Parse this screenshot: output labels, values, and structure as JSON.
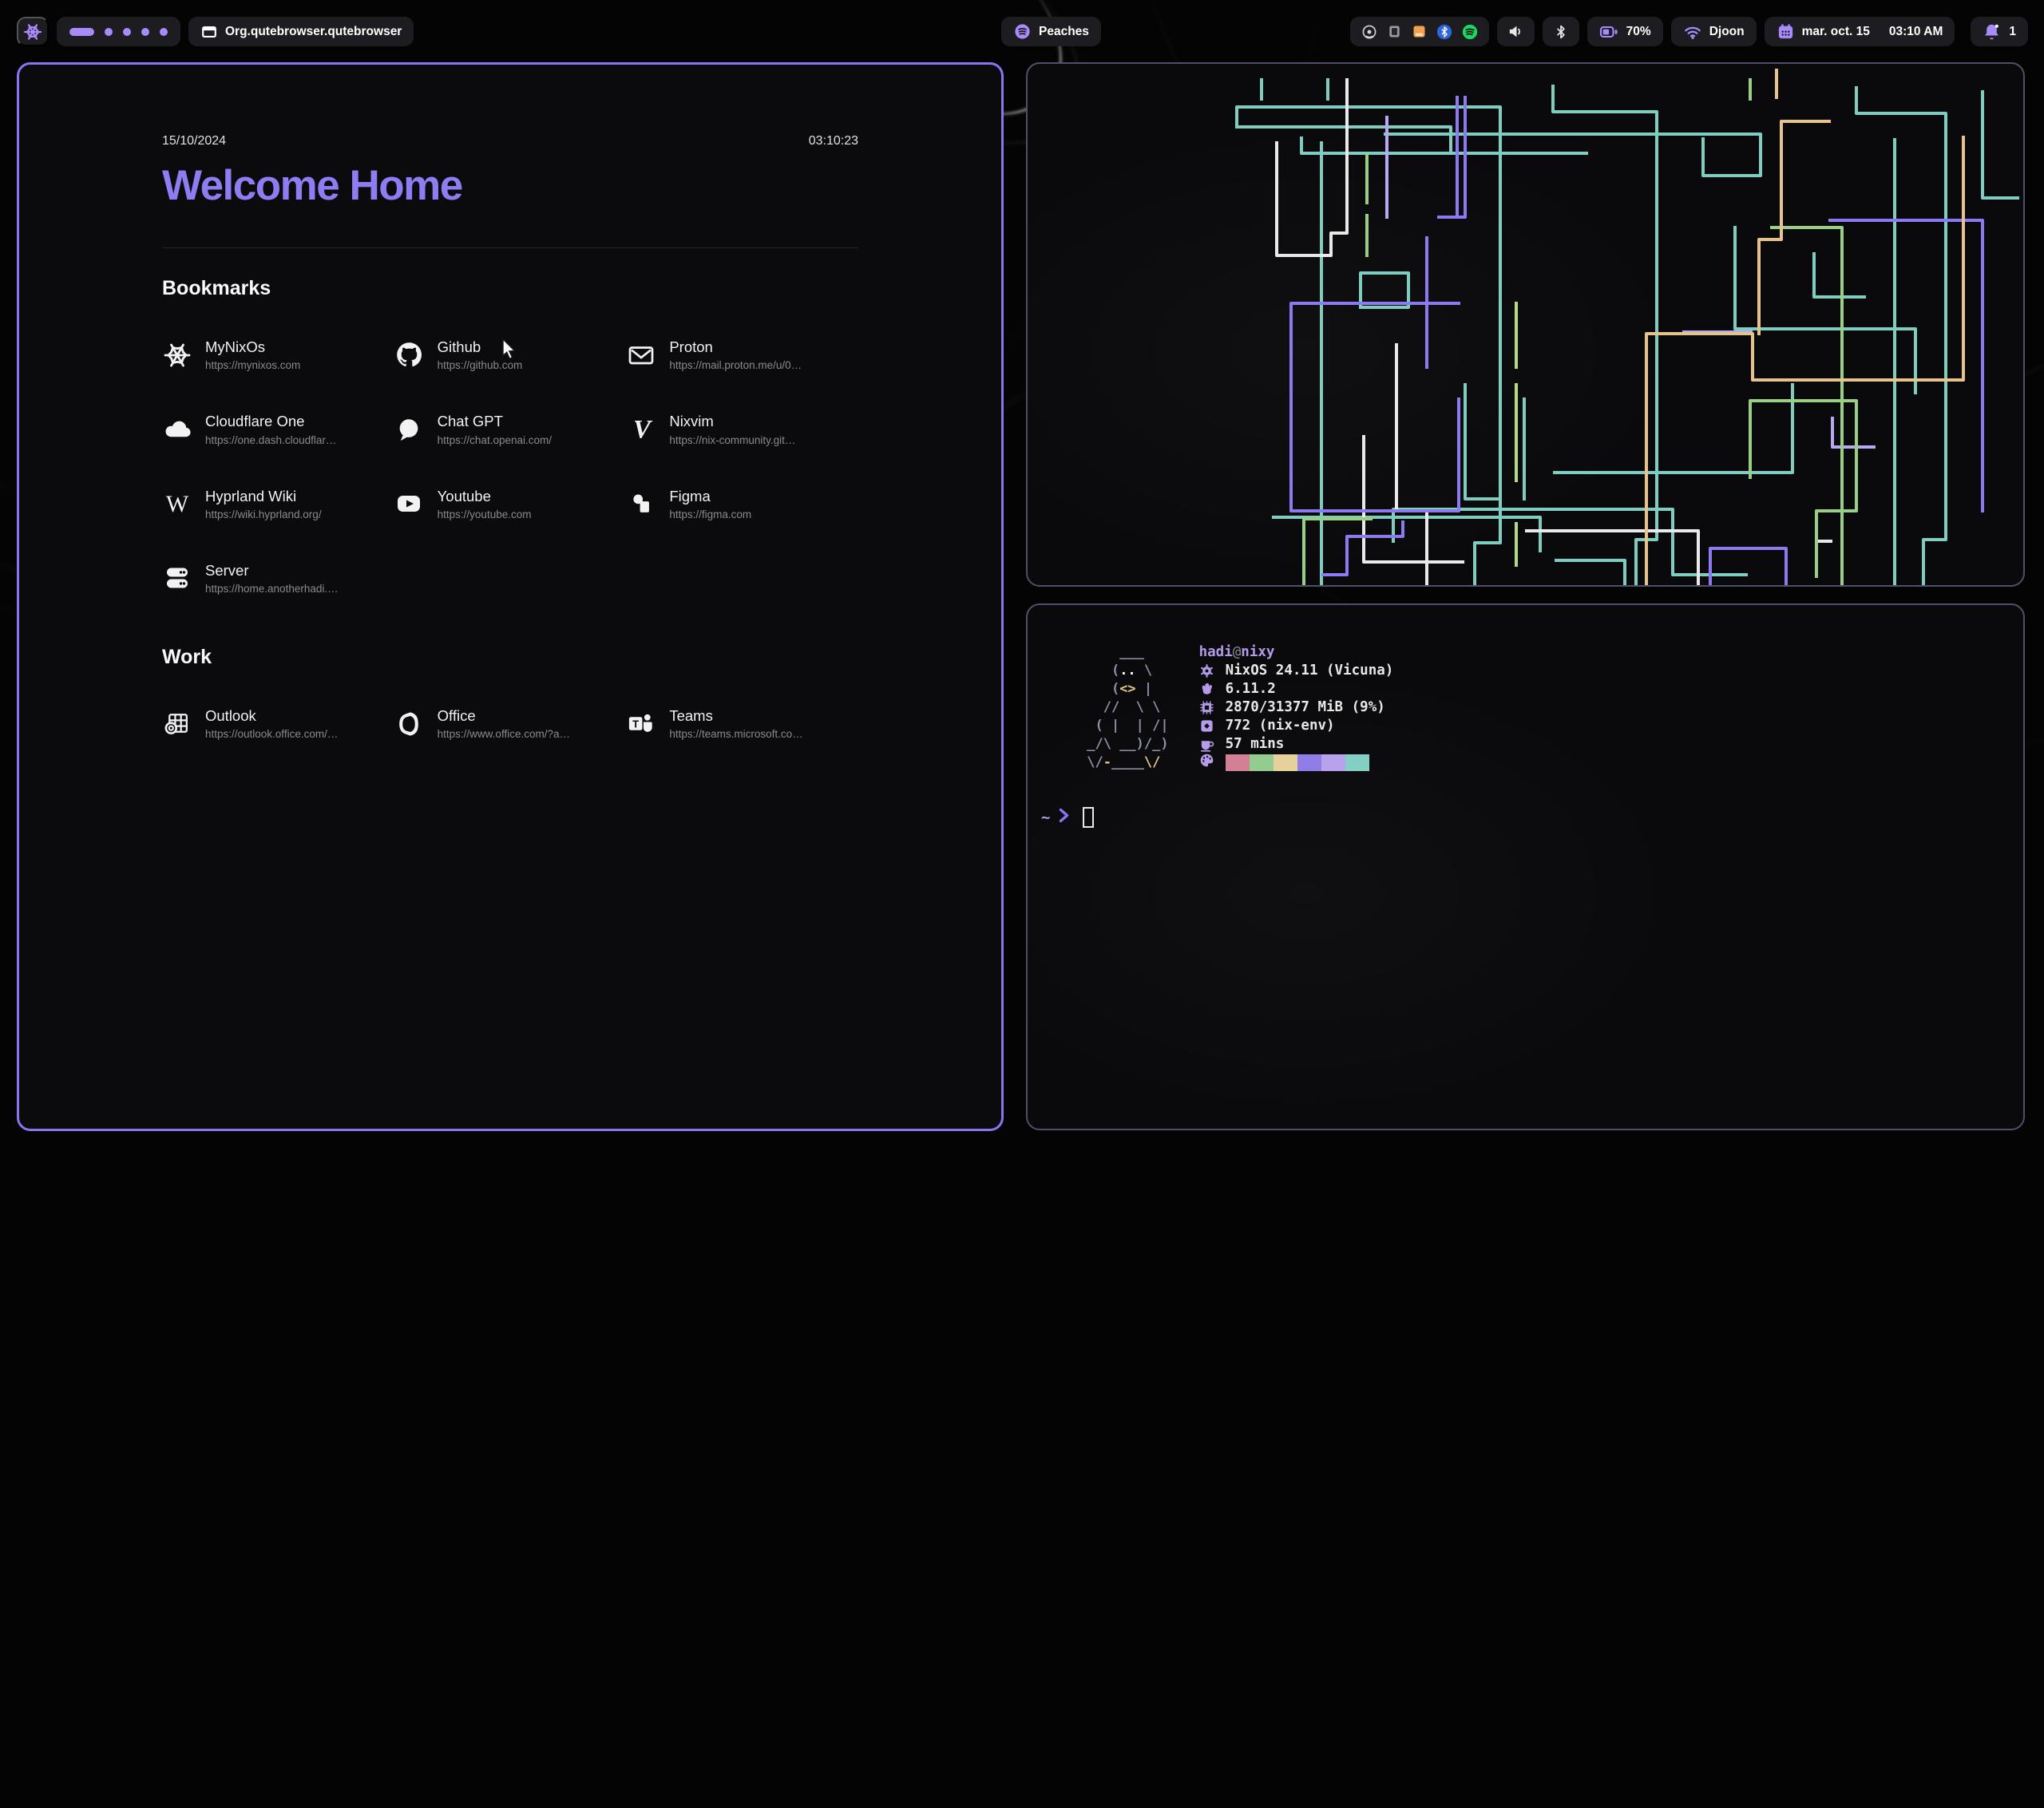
{
  "colors": {
    "accent": "#a78bfa",
    "heading_purple": "#8d7cf2",
    "white_icon": "#f2f2f2",
    "mauve": "#b49bea",
    "chip_bg": "#1d1d21",
    "window_bg": "#0b0b0d",
    "active_border": "#8b74f2",
    "inactive_border": "#4e5166"
  },
  "topbar": {
    "launcher": {
      "icon": "nix-snowflake"
    },
    "workspaces": {
      "active": 1,
      "total": 5
    },
    "window": {
      "icon": "window",
      "title": "Org.qutebrowser.qutebrowser"
    },
    "media": {
      "icon": "music-disc",
      "label": "Peaches"
    },
    "tray_icons": [
      "screencast",
      "app-indicator",
      "files",
      "bluetooth-badge",
      "spotify"
    ],
    "volume": {
      "icon": "speaker"
    },
    "bluetooth": {
      "icon": "bluetooth"
    },
    "battery": {
      "icon": "battery",
      "level": "70%"
    },
    "network": {
      "icon": "wifi",
      "ssid": "Djoon"
    },
    "clock": {
      "icon": "calendar",
      "date": "mar. oct. 15",
      "time": "03:10 AM"
    },
    "notifications": {
      "icon": "bell",
      "count": "1"
    }
  },
  "startpage": {
    "date": "15/10/2024",
    "time": "03:10:23",
    "title": "Welcome Home",
    "sections": [
      {
        "title": "Bookmarks",
        "items": [
          {
            "name": "MyNixOs",
            "url": "https://mynixos.com",
            "icon": "nix"
          },
          {
            "name": "Github",
            "url": "https://github.com",
            "icon": "github"
          },
          {
            "name": "Proton",
            "url": "https://mail.proton.me/u/0…",
            "icon": "mail"
          },
          {
            "name": "Cloudflare One",
            "url": "https://one.dash.cloudflar…",
            "icon": "cloud"
          },
          {
            "name": "Chat GPT",
            "url": "https://chat.openai.com/",
            "icon": "chat"
          },
          {
            "name": "Nixvim",
            "url": "https://nix-community.git…",
            "icon": "nixvim"
          },
          {
            "name": "Hyprland Wiki",
            "url": "https://wiki.hyprland.org/",
            "icon": "wikipedia"
          },
          {
            "name": "Youtube",
            "url": "https://youtube.com",
            "icon": "youtube"
          },
          {
            "name": "Figma",
            "url": "https://figma.com",
            "icon": "figma"
          },
          {
            "name": "Server",
            "url": "https://home.anotherhadi.…",
            "icon": "server"
          }
        ]
      },
      {
        "title": "Work",
        "items": [
          {
            "name": "Outlook",
            "url": "https://outlook.office.com/…",
            "icon": "outlook"
          },
          {
            "name": "Office",
            "url": "https://www.office.com/?a…",
            "icon": "office"
          },
          {
            "name": "Teams",
            "url": "https://teams.microsoft.co…",
            "icon": "teams"
          }
        ]
      }
    ]
  },
  "terminal": {
    "user": "hadi",
    "separator": "@",
    "host": "nixy",
    "info": [
      {
        "icon": "os",
        "text": "NixOS 24.11 (Vicuna)"
      },
      {
        "icon": "kernel",
        "text": "6.11.2"
      },
      {
        "icon": "memory",
        "text": "2870/31377 MiB (9%)"
      },
      {
        "icon": "packages",
        "text": "772 (nix-env)"
      },
      {
        "icon": "uptime",
        "text": "57 mins"
      }
    ],
    "palette": [
      "#d47f93",
      "#93cc8e",
      "#e7d19a",
      "#8f7ce8",
      "#b7a1ec",
      "#82cfc3"
    ],
    "ascii": [
      [
        {
          "t": "     ___  ",
          "c": "s"
        }
      ],
      [
        {
          "t": "    (",
          "c": "s"
        },
        {
          "t": "..",
          "c": "w"
        },
        {
          "t": " \\",
          "c": "s"
        }
      ],
      [
        {
          "t": "    (",
          "c": "s"
        },
        {
          "t": "<>",
          "c": "y"
        },
        {
          "t": " |",
          "c": "s"
        }
      ],
      [
        {
          "t": "   //  \\ \\",
          "c": "s"
        }
      ],
      [
        {
          "t": "  ( |  | /|",
          "c": "s"
        }
      ],
      [
        {
          "t": " _/\\ __)/_)",
          "c": "s"
        }
      ],
      [
        {
          "t": " \\/",
          "c": "s"
        },
        {
          "t": "-",
          "c": "y"
        },
        {
          "t": "____",
          "c": "s"
        },
        {
          "t": "\\/",
          "c": "y"
        }
      ]
    ],
    "prompt": {
      "dir": "~",
      "symbol": "❯"
    }
  },
  "pipes_art": {
    "stroke_width": 4,
    "palette": {
      "t": "#7fccc1",
      "g": "#98cf85",
      "lg": "#b5d98a",
      "w": "#e9e9e9",
      "p": "#8b7af0",
      "l": "#b9a8f2",
      "n": "#e6c38c"
    },
    "paths": [
      {
        "c": "t",
        "d": "293,20 293,44"
      },
      {
        "c": "t",
        "d": "376,20 376,44"
      },
      {
        "c": "t",
        "d": "262,79 262,54 592,54 592,600 560,600 560,653"
      },
      {
        "c": "t",
        "d": "262,79 530,79 530,110"
      },
      {
        "c": "t",
        "d": "343,93 343,112 700,112"
      },
      {
        "c": "t",
        "d": "448,88 918,88 918,140 846,140 846,94"
      },
      {
        "c": "t",
        "d": "368,99 368,653"
      },
      {
        "c": "t",
        "d": "658,28 658,60 788,60 788,596 762,596 762,653"
      },
      {
        "c": "t",
        "d": "548,402 548,545 592,545 592,420"
      },
      {
        "c": "t",
        "d": "622,420 622,545"
      },
      {
        "c": "t",
        "d": "660,512 958,512 958,402"
      },
      {
        "c": "t",
        "d": "308,568 642,568 642,610"
      },
      {
        "c": "t",
        "d": "458,598 458,558 808,558 808,640 900,640"
      },
      {
        "c": "t",
        "d": "886,205 886,332 1112,332 1112,412"
      },
      {
        "c": "t",
        "d": "1196,35 1196,168 1240,168"
      },
      {
        "c": "t",
        "d": "662,622 748,622 748,653"
      },
      {
        "c": "t",
        "d": "985,238 985,292 1048,292"
      },
      {
        "c": "t",
        "d": "1038,30 1038,62 1150,62 1150,596 1122,596 1122,653"
      },
      {
        "c": "t",
        "d": "1086,95 1086,653"
      },
      {
        "c": "t",
        "d": "417,305 417,262 477,262 477,305 419,305"
      },
      {
        "c": "w",
        "d": "312,99 312,240 380,240 380,212 400,212 400,20"
      },
      {
        "c": "w",
        "d": "421,467 421,624 545,624"
      },
      {
        "c": "w",
        "d": "462,352 462,560 500,560 500,653"
      },
      {
        "c": "w",
        "d": "625,585 840,585 840,653"
      },
      {
        "c": "w",
        "d": "988,598 1006,598"
      },
      {
        "c": "p",
        "d": "538,42 538,192"
      },
      {
        "c": "p",
        "d": "548,42 548,192 515,192"
      },
      {
        "c": "p",
        "d": "540,300 330,300 330,560 540,560 540,420"
      },
      {
        "c": "p",
        "d": "500,218 500,380"
      },
      {
        "c": "p",
        "d": "855,653 855,607 950,607 950,653"
      },
      {
        "c": "p",
        "d": "1005,196 1196,196 1196,560"
      },
      {
        "c": "p",
        "d": "370,640 400,640 400,592 470,592 470,574"
      },
      {
        "c": "l",
        "d": "450,67 450,192"
      },
      {
        "c": "l",
        "d": "822,336 906,336"
      },
      {
        "c": "l",
        "d": "1060,480 1008,480 1008,444"
      },
      {
        "c": "g",
        "d": "932,205 1020,205 1020,653"
      },
      {
        "c": "g",
        "d": "425,114 425,174"
      },
      {
        "c": "g",
        "d": "425,190 425,240"
      },
      {
        "c": "g",
        "d": "905,518 905,422 1038,422 1038,560 988,560 988,642"
      },
      {
        "c": "g",
        "d": "905,20 905,44"
      },
      {
        "c": "g",
        "d": "430,570 346,570 346,653"
      },
      {
        "c": "lg",
        "d": "612,300 612,380"
      },
      {
        "c": "lg",
        "d": "612,402 612,522"
      },
      {
        "c": "lg",
        "d": "612,576 612,628"
      },
      {
        "c": "n",
        "d": "1172,92 1172,396 908,396 908,338 775,338 775,653"
      },
      {
        "c": "n",
        "d": "938,8 938,42"
      },
      {
        "c": "n",
        "d": "1004,72 944,72 944,220 916,220 916,338"
      }
    ]
  }
}
